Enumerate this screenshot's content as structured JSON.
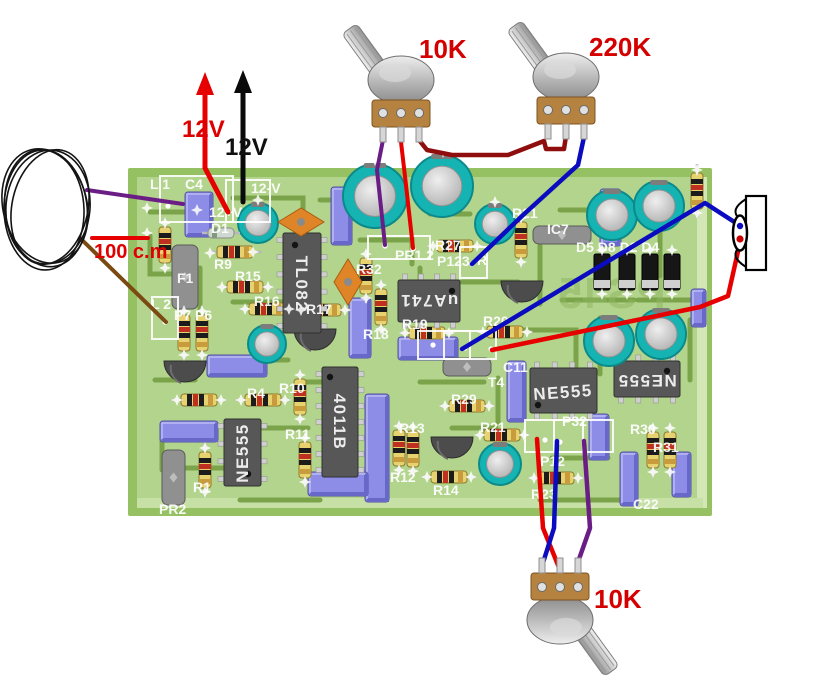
{
  "labels": {
    "pot_top_left": "10K",
    "pot_top_right": "220K",
    "pot_bottom": "10K",
    "supply_positive": "12V",
    "supply_negative": "12V",
    "coil_length": "100 c.m",
    "watermark": "PS45"
  },
  "ics": [
    "TL082",
    "uA741",
    "NE555",
    "4011B",
    "NE555",
    "NE555"
  ],
  "silk": [
    "L 1",
    "C4",
    "12-V",
    "12+V",
    "D1",
    "R9",
    "R15",
    "R16",
    "F1",
    "L 2",
    "P7 P6",
    "R17",
    "R32",
    "R18",
    "R19",
    "R27",
    "PR1 2",
    "P123",
    "R",
    "R21",
    "IC7",
    "D5 D8 D2 D4",
    "R20",
    "C11",
    "T4",
    "R29",
    "R4",
    "R10",
    "R11",
    "R13",
    "R12",
    "R14",
    "R21",
    "R23",
    "P32",
    "P12",
    "R30",
    "R31",
    "C22",
    "R1",
    "PR2"
  ],
  "colors": {
    "board_green": "#b3d48d",
    "trace_green": "#7ba44a",
    "silk_white": "#ffffff",
    "wire_red": "#e60000",
    "wire_dark_red": "#8f0d0d",
    "wire_blue": "#0b0bc0",
    "wire_purple": "#6b1d86",
    "wire_brown": "#7b4a12",
    "wire_black": "#000000",
    "annotation_red": "#dd0000",
    "capacitor_blue": "#8d8de8",
    "electrolytic_teal": "#16b3b3",
    "resistor_yellow": "#e6d26e",
    "ic_gray": "#575757",
    "pot_base_brass": "#b5823f"
  }
}
